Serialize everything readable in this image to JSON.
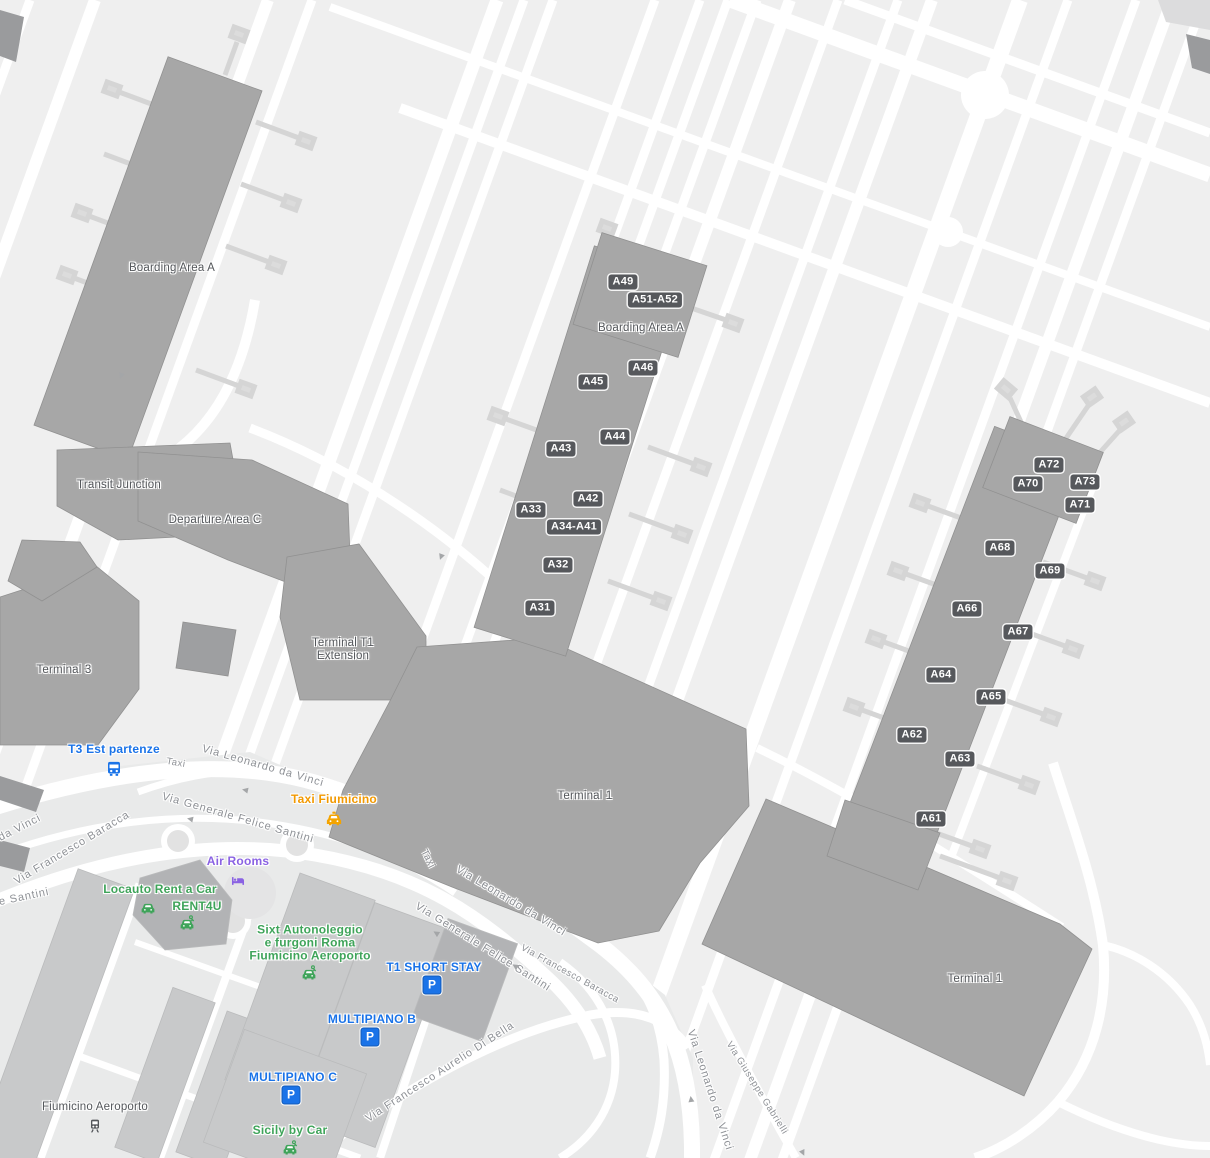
{
  "areas": {
    "boarding_area_a": "Boarding Area A",
    "transit_junction": "Transit Junction",
    "departure_area_c": "Departure Area C",
    "terminal_3": "Terminal 3",
    "terminal_t1_extension_line1": "Terminal T1",
    "terminal_t1_extension_line2": "Extension",
    "terminal_1": "Terminal 1",
    "fiumicino_aeroporto_station": "Fiumicino Aeroporto"
  },
  "gates": {
    "a31": "A31",
    "a32": "A32",
    "a33": "A33",
    "a34_a41": "A34-A41",
    "a42": "A42",
    "a43": "A43",
    "a44": "A44",
    "a45": "A45",
    "a46": "A46",
    "a49": "A49",
    "a51_a52": "A51-A52",
    "a61": "A61",
    "a62": "A62",
    "a63": "A63",
    "a64": "A64",
    "a65": "A65",
    "a66": "A66",
    "a67": "A67",
    "a68": "A68",
    "a69": "A69",
    "a70": "A70",
    "a71": "A71",
    "a72": "A72",
    "a73": "A73"
  },
  "pois": {
    "t3_est_partenze": "T3 Est partenze",
    "taxi_fiumicino": "Taxi Fiumicino",
    "air_rooms": "Air Rooms",
    "locauto_rent_a_car": "Locauto Rent a Car",
    "rent4u": "RENT4U",
    "sixt_line1": "Sixt Autonoleggio",
    "sixt_line2": "e furgoni Roma",
    "sixt_line3": "Fiumicino Aeroporto",
    "t1_short_stay": "T1 SHORT STAY",
    "multipiano_b": "MULTIPIANO B",
    "multipiano_c": "MULTIPIANO C",
    "sicily_by_car": "Sicily by Car",
    "parking_symbol": "P"
  },
  "roads": {
    "via_leonardo_da_vinci": "Via Leonardo da Vinci",
    "via_generale_felice_santini": "Via Generale Felice Santini",
    "via_francesco_baracca": "Via Francesco Baracca",
    "via_francesco_aurelio_di_bella": "Via Francesco Aurelio Di Bella",
    "via_giuseppe_gabrielli": "Via Giuseppe Gabrielli",
    "taxi_lane": "Taxi"
  },
  "colors": {
    "background": "#efefef",
    "road": "#ffffff",
    "terminal_building": "#a7a7a7",
    "landside_building": "#c8c9ca",
    "gate_badge": "#56585c",
    "transit_blue": "#1a73e8",
    "poi_green": "#3fa45a",
    "poi_orange": "#f29900",
    "poi_purple": "#8a62e3",
    "area_label_gray": "#54575b",
    "road_label_gray": "#8e9196"
  }
}
